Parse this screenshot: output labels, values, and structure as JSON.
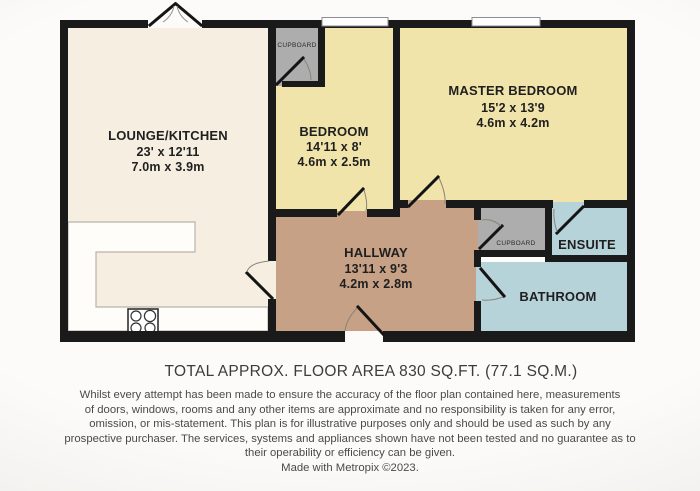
{
  "plan": {
    "rooms": {
      "lounge": {
        "name": "LOUNGE/KITCHEN",
        "imperial": "23' x 12'11",
        "metric": "7.0m x 3.9m"
      },
      "bedroom": {
        "name": "BEDROOM",
        "imperial": "14'11 x 8'",
        "metric": "4.6m x 2.5m"
      },
      "master": {
        "name": "MASTER BEDROOM",
        "imperial": "15'2 x 13'9",
        "metric": "4.6m x 4.2m"
      },
      "hallway": {
        "name": "HALLWAY",
        "imperial": "13'11 x 9'3",
        "metric": "4.2m x 2.8m"
      },
      "ensuite": {
        "name": "ENSUITE"
      },
      "bathroom": {
        "name": "BATHROOM"
      },
      "cupboard_top": {
        "name": "CUPBOARD"
      },
      "cupboard_right": {
        "name": "CUPBOARD"
      }
    },
    "colors": {
      "lounge": "#f5eee1",
      "bedroom": "#f1e4ab",
      "hallway": "#c7a185",
      "cupboard": "#adadad",
      "wetroom": "#b7d3da",
      "wall": "#1a1a1a",
      "counter": "#fefdfa",
      "window": "#ffffff"
    }
  },
  "footer": {
    "area_title": "TOTAL APPROX. FLOOR AREA 830 SQ.FT. (77.1 SQ.M.)",
    "disclaimer_lines": [
      "Whilst every attempt has been made to ensure the accuracy of the floor plan contained here, measurements",
      "of doors, windows, rooms and any other items are approximate and no responsibility is taken for any error,",
      "omission, or mis-statement. This plan is for illustrative purposes only and should be used as such by any",
      "prospective purchaser. The services, systems and appliances shown have not been tested and no guarantee as to",
      "their operability or efficiency can be given.",
      "Made with Metropix ©2023."
    ]
  }
}
